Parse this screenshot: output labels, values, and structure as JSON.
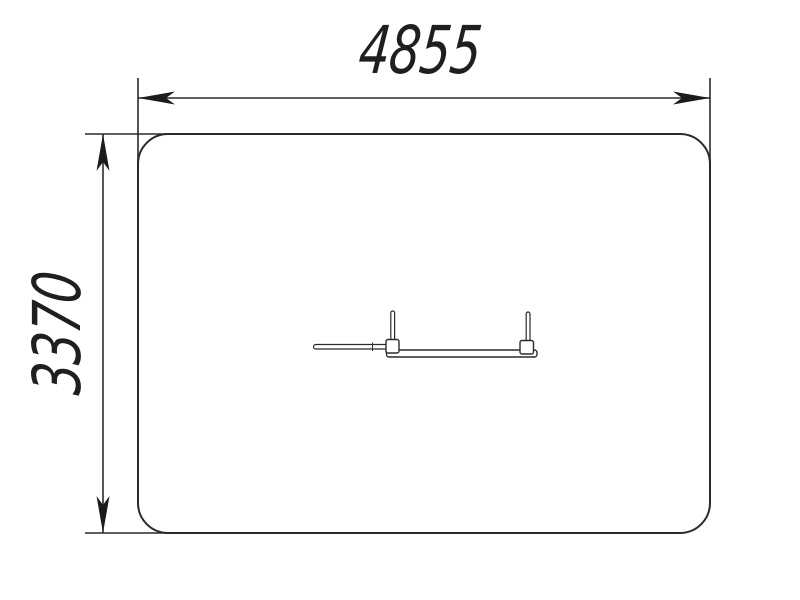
{
  "drawing": {
    "type": "technical-dimension-drawing",
    "background": "#ffffff",
    "line_color": "#2b2b2b",
    "text_color": "#1f1f1f",
    "dimensions": {
      "width": {
        "label": "4855"
      },
      "height": {
        "label": "3370"
      }
    }
  }
}
